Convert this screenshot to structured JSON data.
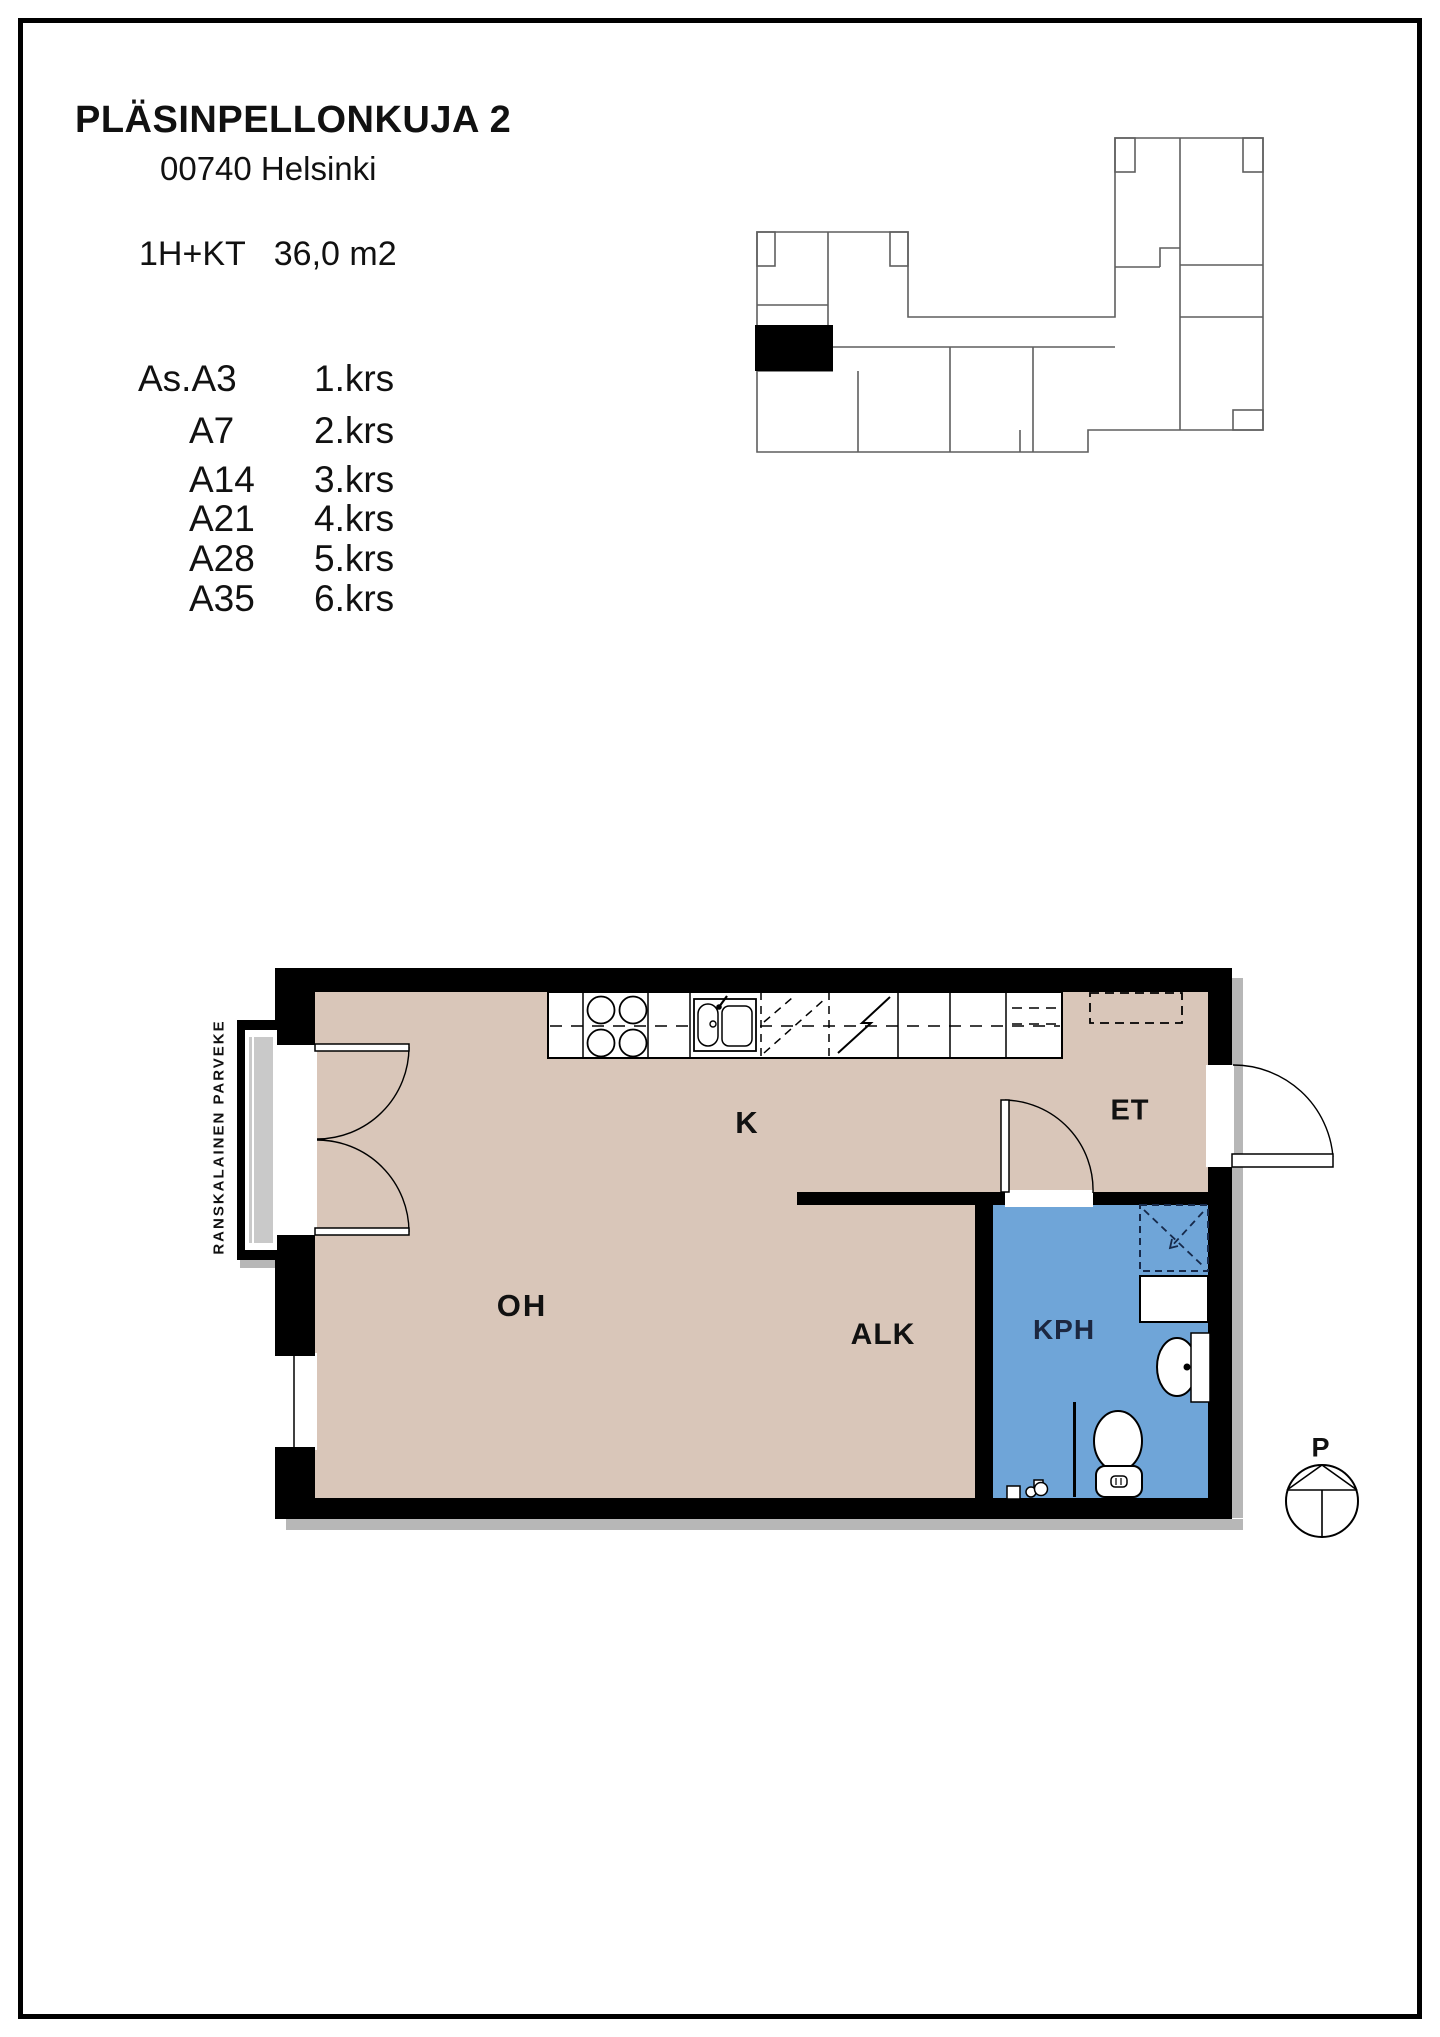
{
  "header": {
    "title": "PLÄSINPELLONKUJA 2",
    "address": "00740 Helsinki",
    "apartment_type": "1H+KT",
    "area": "36,0 m2"
  },
  "apartment_list": [
    {
      "unit": "As.A3",
      "floor": "1.krs"
    },
    {
      "unit": "A7",
      "floor": "2.krs"
    },
    {
      "unit": "A14",
      "floor": "3.krs"
    },
    {
      "unit": "A21",
      "floor": "4.krs"
    },
    {
      "unit": "A28",
      "floor": "5.krs"
    },
    {
      "unit": "A35",
      "floor": "6.krs"
    }
  ],
  "floor_plan": {
    "room_labels": {
      "kitchen": "K",
      "entry": "ET",
      "living_room": "OH",
      "alcove": "ALK",
      "bathroom": "KPH"
    },
    "balcony_label": "RANSKALAINEN PARVEKE",
    "compass_label": "P"
  },
  "colors": {
    "floor": "#d9c6b9",
    "bathroom_floor": "#6fa5d8",
    "wall": "#000000",
    "balcony_slab": "#c9c9c9",
    "shadow": "#b7b7b7",
    "keyplan_line": "#5f5f5f",
    "keyplan_highlight": "#000000",
    "shower_dash": "#16294a"
  }
}
